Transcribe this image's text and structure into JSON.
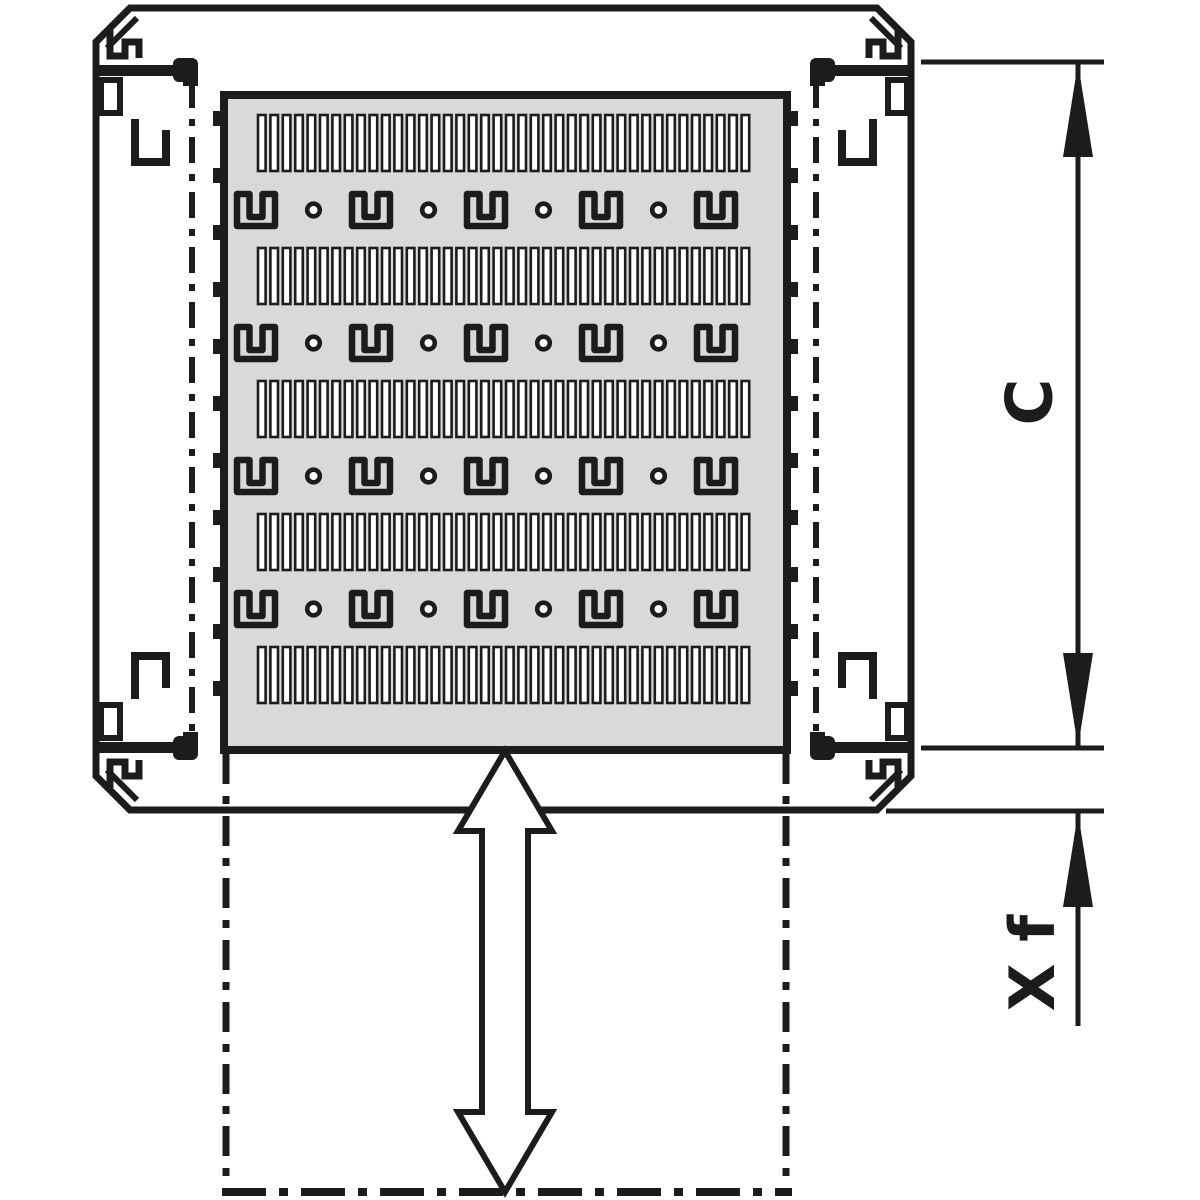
{
  "diagram": {
    "kind": "technical-drawing-top-view",
    "labels": {
      "dim_c": "C",
      "dim_xf": "X f"
    },
    "colors": {
      "line": "#1c1c1c",
      "plate": "#d9d9d9",
      "bg": "#ffffff"
    },
    "plate": {
      "slot_bands": 5,
      "slots_per_band": 40,
      "keyhole_rows": 4,
      "brackets_per_row": 5,
      "dots_per_row": 4,
      "edge_notches_per_side": 11
    }
  }
}
